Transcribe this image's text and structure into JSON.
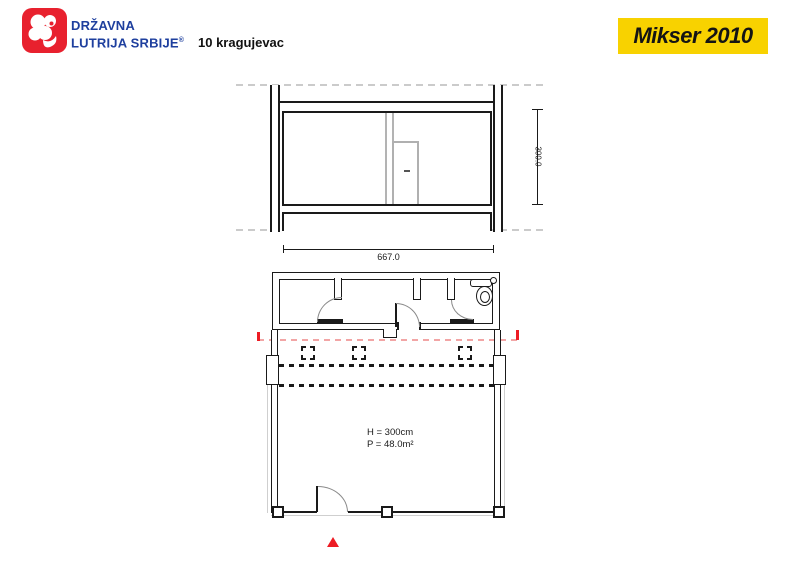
{
  "header": {
    "logo": {
      "line1": "DRŽAVNA",
      "line2": "LUTRIJA SRBIJE",
      "registered_mark": "®"
    },
    "title": "10 kragujevac",
    "badge": "Mikser 2010"
  },
  "elevation": {
    "height_dim": "300.0",
    "width_dim": "667.0"
  },
  "plan": {
    "ceiling_height": "H = 300cm",
    "area": "P = 48.0m²"
  },
  "colors": {
    "brand_red": "#e8212e",
    "brand_blue": "#1e3f9e",
    "badge_yellow": "#f8d200",
    "line_black": "#1a1a1a",
    "line_gray": "#b3b3b3",
    "marker_red": "#ed1c24"
  }
}
